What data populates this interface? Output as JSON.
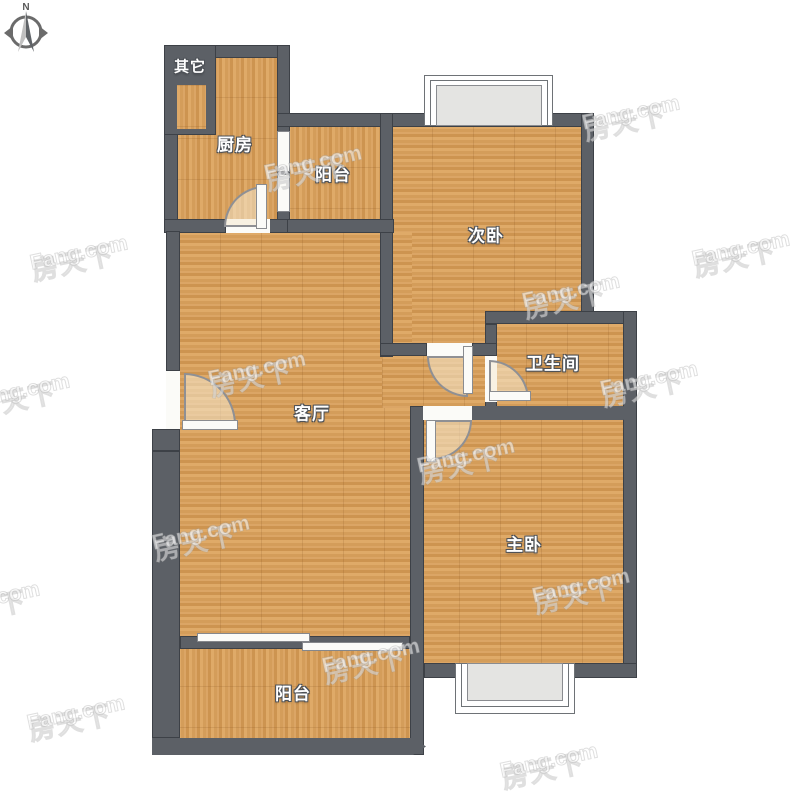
{
  "compass": {
    "north": "N"
  },
  "watermark": {
    "cjk": "房天下",
    "latin": "Fang.com"
  },
  "rooms": {
    "other": {
      "label": "其它"
    },
    "kitchen": {
      "label": "厨房"
    },
    "balcony_top": {
      "label": "阳台"
    },
    "second_bedroom": {
      "label": "次卧"
    },
    "bathroom": {
      "label": "卫生间"
    },
    "living_room": {
      "label": "客厅"
    },
    "master_bedroom": {
      "label": "主卧"
    },
    "balcony_bottom": {
      "label": "阳台"
    }
  },
  "colors": {
    "wall": "#5c6066",
    "wall_outline": "#3d4147",
    "floor_wood": "#d7a160",
    "opening_white": "#fbfbf8",
    "bay_fill": "#e4e4e2",
    "door_swing_fill": "#f6e9cf",
    "label_text": "#ffffff"
  }
}
